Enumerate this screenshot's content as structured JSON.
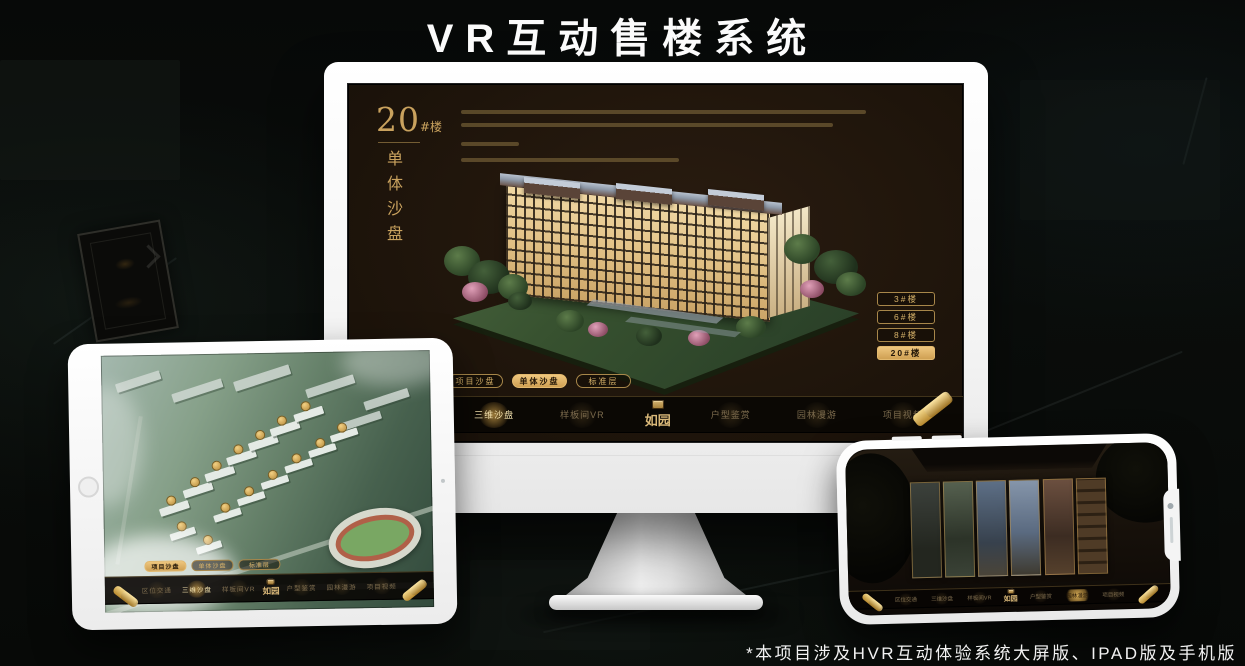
{
  "banner": {
    "title": "VR互动售楼系统"
  },
  "footnote": {
    "text": "*本项目涉及HVR互动体验系统大屏版、IPAD版及手机版"
  },
  "colors": {
    "gold": "#d0a55c",
    "gold_fill": "#e0b367",
    "screen_bg": "#1c130a",
    "nav_bg": "#0b0804"
  },
  "desktop": {
    "block_title_num": "20",
    "block_title_suffix": "#楼",
    "block_subtitle_vertical": "单体沙盘",
    "floor_buttons": [
      {
        "label": "3#楼"
      },
      {
        "label": "6#楼"
      },
      {
        "label": "8#楼"
      },
      {
        "label": "20#楼"
      }
    ],
    "mode_tabs": [
      {
        "label": "项目沙盘"
      },
      {
        "label": "单体沙盘"
      },
      {
        "label": "标准层"
      }
    ],
    "nav": {
      "left": [
        {
          "label": "区位交通"
        },
        {
          "label": "三维沙盘"
        },
        {
          "label": "样板间VR"
        }
      ],
      "logo": "如园",
      "right": [
        {
          "label": "户型鉴赏"
        },
        {
          "label": "园林漫游"
        },
        {
          "label": "项目视频"
        }
      ]
    }
  },
  "tablet": {
    "mode_tabs": [
      {
        "label": "项目沙盘"
      },
      {
        "label": "单体沙盘"
      },
      {
        "label": "标准层"
      }
    ],
    "nav": {
      "left": [
        {
          "label": "区位交通"
        },
        {
          "label": "三维沙盘"
        },
        {
          "label": "样板间VR"
        }
      ],
      "logo": "如园",
      "right": [
        {
          "label": "户型鉴赏"
        },
        {
          "label": "园林漫游"
        },
        {
          "label": "项目视频"
        }
      ]
    }
  },
  "phone": {
    "nav": {
      "left": [
        {
          "label": "区位交通"
        },
        {
          "label": "三维沙盘"
        },
        {
          "label": "样板间VR"
        }
      ],
      "logo": "如园",
      "right": [
        {
          "label": "户型鉴赏"
        },
        {
          "label": "园林漫游"
        },
        {
          "label": "项目视频"
        }
      ]
    }
  }
}
